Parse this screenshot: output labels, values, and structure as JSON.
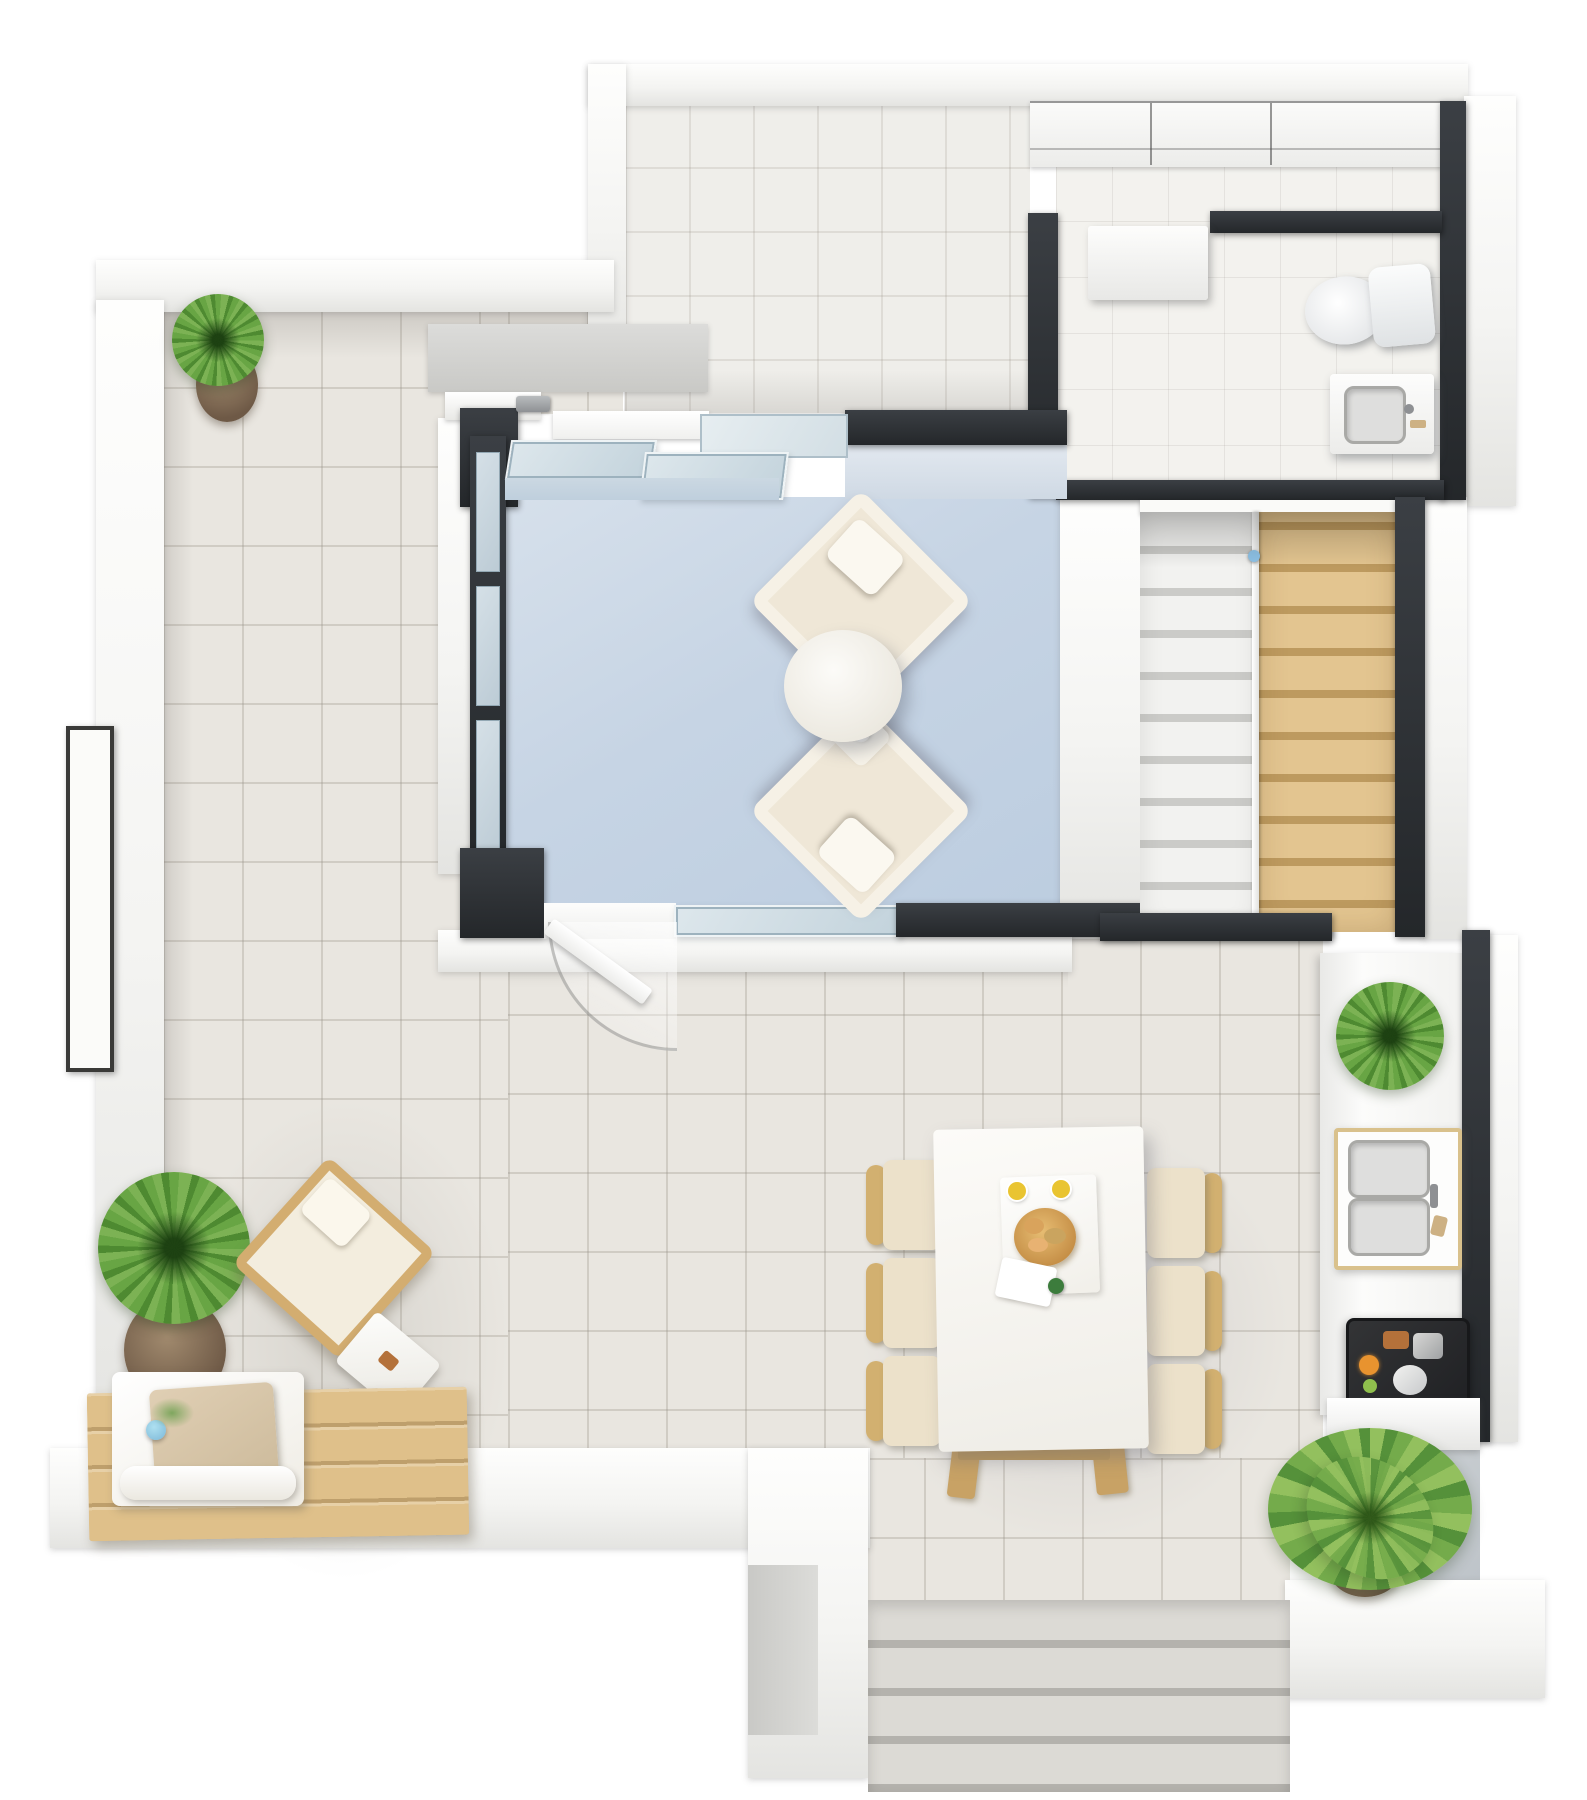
{
  "meta": {
    "title": "3D floor plan — top-down dollhouse render",
    "view": "top-down 3D render, white and charcoal walls, no text labels"
  },
  "palette": {
    "background": "#ffffff",
    "wall_white": "#f4f4f2",
    "wall_dark": "#2c3034",
    "terrace_tile": "#e9e6e0",
    "hall_tile": "#efeeea",
    "bath_tile": "#f3f2ee",
    "living_floor": "#c6d4e4",
    "glass": "#cfdde6",
    "stair_wood": "#dcbe88",
    "stair_white": "#f0f0ee",
    "furniture_wood": "#d2b070",
    "cushion_beige": "#ece1ca",
    "sofa_cream": "#efe7d7",
    "plant_green": "#68a544",
    "pot_brown": "#8a7460",
    "cooktop_dark": "#2b2c2e",
    "vase_blue": "#8ec2e6",
    "drink_yellow": "#e9c431",
    "bread_tan": "#d9a35c"
  },
  "rooms": {
    "entrance_hall": {
      "label": "Entrance hall",
      "features": [
        "built-in closet",
        "tiled floor"
      ]
    },
    "bathroom": {
      "label": "Bathroom",
      "fixtures": [
        "toilet",
        "washbasin vanity",
        "floating wall shelf"
      ]
    },
    "living_room": {
      "label": "Living room",
      "floor": "light blue",
      "furniture": [
        "two cream armchairs",
        "round coffee table"
      ],
      "features": [
        "glass sliding door",
        "glazed wall to terrace",
        "terrace door"
      ]
    },
    "staircase": {
      "label": "Staircase",
      "left_flight": "white-grey treads",
      "right_flight": "wooden treads",
      "railing": "slim centre railing with blue cap",
      "treads_per_flight": 10
    },
    "kitchen": {
      "label": "Kitchen counter",
      "items": [
        "counter plant",
        "double-basin sink",
        "dark cooktop with food"
      ]
    },
    "terrace": {
      "label": "Terrace",
      "furniture": [
        "corner potted plant",
        "large potted plant",
        "timber lounge chair",
        "side tray table",
        "timber daybed with cushions and blue vase",
        "dining table for six"
      ],
      "features": [
        "perimeter parapet wall",
        "slot window in left wall",
        "four exit steps",
        "potted palm at lower right"
      ]
    }
  },
  "dining": {
    "table": "white rectangular table with timber legs",
    "chairs": 6,
    "tabletop_items": [
      "white placemat",
      "bread basket",
      "two yellow drinks",
      "green garnish",
      "napkin"
    ]
  },
  "counts": {
    "armchairs": 2,
    "dining_chairs": 6,
    "plants": 4,
    "exit_steps": 4,
    "stair_treads_visible": 20
  },
  "labels": {
    "plan": "3D floor plan – top-down view",
    "entrance_hall": "Entrance hall",
    "closet": "Built-in closet",
    "bathroom": "Bathroom",
    "toilet": "Toilet",
    "sink": "Washbasin vanity",
    "shelf": "Floating wall shelf",
    "living_room": "Living room",
    "sliding_door": "Glass sliding door",
    "glass_wall": "Glazed wall",
    "armchair": "Cream armchair",
    "coffee_table": "Round coffee table",
    "terrace_door": "Terrace door",
    "staircase": "Staircase",
    "railing": "Stair railing",
    "kitchen": "Kitchen counter",
    "counter_plant": "Counter plant",
    "kitchen_sink": "Double-basin sink",
    "cooktop": "Cooktop with food",
    "terrace": "Terrace",
    "corner_plant": "Potted plant",
    "large_plant": "Large potted plant",
    "lounge_chair": "Timber lounge chair",
    "tray_table": "Side tray table",
    "daybed": "Timber daybed",
    "vase": "Blue vase with flowers",
    "dining_table": "Dining table",
    "dining_chair": "Dining chair",
    "food": "Breakfast set",
    "steps": "Exit steps",
    "parapet": "Parapet wall",
    "window": "Slot window",
    "palm": "Potted palm"
  }
}
